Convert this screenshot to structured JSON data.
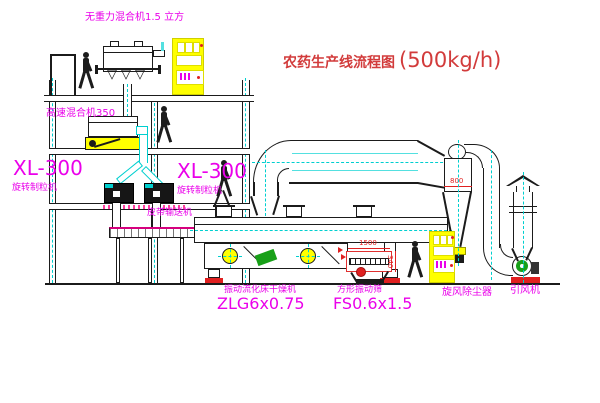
{
  "title": {
    "text_cn": "农药生产线流程图",
    "capacity": "(500kg/h)"
  },
  "equipment_labels": {
    "gravity_mixer": "无重力混合机1.5 立方",
    "high_speed_mixer": "高速混合机350",
    "granulator_left_model": "XL-300",
    "granulator_left_name": "旋转制粒机",
    "granulator_right_model": "XL-300",
    "granulator_right_name": "旋转制粒机",
    "belt_conveyor": "皮带输送机",
    "fluid_bed_dryer_name": "振动流化床干燥机",
    "fluid_bed_dryer_model": "ZLG6x0.75",
    "vibrating_screen_name": "方形振动筛",
    "vibrating_screen_model": "FS0.6x1.5",
    "cyclone_dust_collector": "旋风除尘器",
    "induced_draft_fan": "引风机"
  },
  "dimensions": {
    "cyclone_diameter": "800",
    "screen_length": "1500",
    "screen_height": "340"
  },
  "colors": {
    "title_red": "#d23b3b",
    "label_magenta": "#ea00ea",
    "line_black": "#1b1b1b",
    "centerline_cyan": "#00cfcf",
    "cabinet_yellow": "#ffff00",
    "dimension_red": "#e02020",
    "fan_green": "#18a018",
    "conveyor_accent": "#d6007e"
  }
}
